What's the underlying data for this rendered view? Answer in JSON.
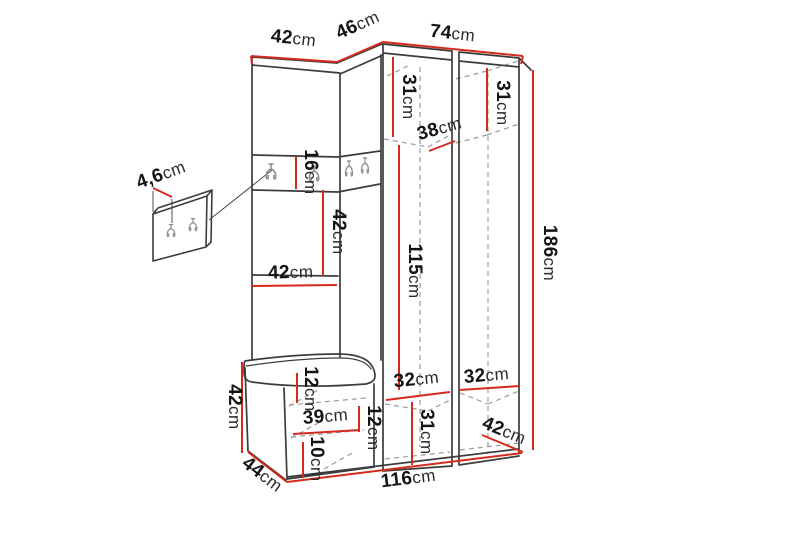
{
  "diagram": {
    "description": "Hallway furniture set dimension drawing",
    "unit": "cm",
    "accent_color": "#d52b1e",
    "outline_color": "#3c3c3c",
    "hidden_line_color": "#9b9b9b"
  },
  "labels": [
    {
      "name": "top-width-left-panel",
      "value": "42",
      "unit": "cm"
    },
    {
      "name": "top-width-corner-section",
      "value": "46",
      "unit": "cm"
    },
    {
      "name": "top-width-wardrobe",
      "value": "74",
      "unit": "cm"
    },
    {
      "name": "upper-compartment-height-left",
      "value": "31",
      "unit": "cm"
    },
    {
      "name": "upper-compartment-height-right",
      "value": "31",
      "unit": "cm"
    },
    {
      "name": "upper-compartment-depth",
      "value": "38",
      "unit": "cm"
    },
    {
      "name": "hook-panel-thickness",
      "value": "4,6",
      "unit": "cm"
    },
    {
      "name": "hook-rail-height",
      "value": "16",
      "unit": "cm"
    },
    {
      "name": "open-section-height",
      "value": "42",
      "unit": "cm"
    },
    {
      "name": "open-shelf-width",
      "value": "42",
      "unit": "cm"
    },
    {
      "name": "wardrobe-door-height",
      "value": "115",
      "unit": "cm"
    },
    {
      "name": "total-height",
      "value": "186",
      "unit": "cm"
    },
    {
      "name": "lower-compartment-width-left",
      "value": "32",
      "unit": "cm"
    },
    {
      "name": "lower-compartment-width-right",
      "value": "32",
      "unit": "cm"
    },
    {
      "name": "bench-top-section-height",
      "value": "12",
      "unit": "cm"
    },
    {
      "name": "lower-compartment-height",
      "value": "31",
      "unit": "cm"
    },
    {
      "name": "bench-shelf-width",
      "value": "39",
      "unit": "cm"
    },
    {
      "name": "bench-side-section-height",
      "value": "12",
      "unit": "cm"
    },
    {
      "name": "bench-base-height",
      "value": "10",
      "unit": "cm"
    },
    {
      "name": "bench-height",
      "value": "42",
      "unit": "cm"
    },
    {
      "name": "bench-depth",
      "value": "44",
      "unit": "cm"
    },
    {
      "name": "total-width",
      "value": "116",
      "unit": "cm"
    },
    {
      "name": "wardrobe-depth",
      "value": "42",
      "unit": "cm"
    }
  ]
}
